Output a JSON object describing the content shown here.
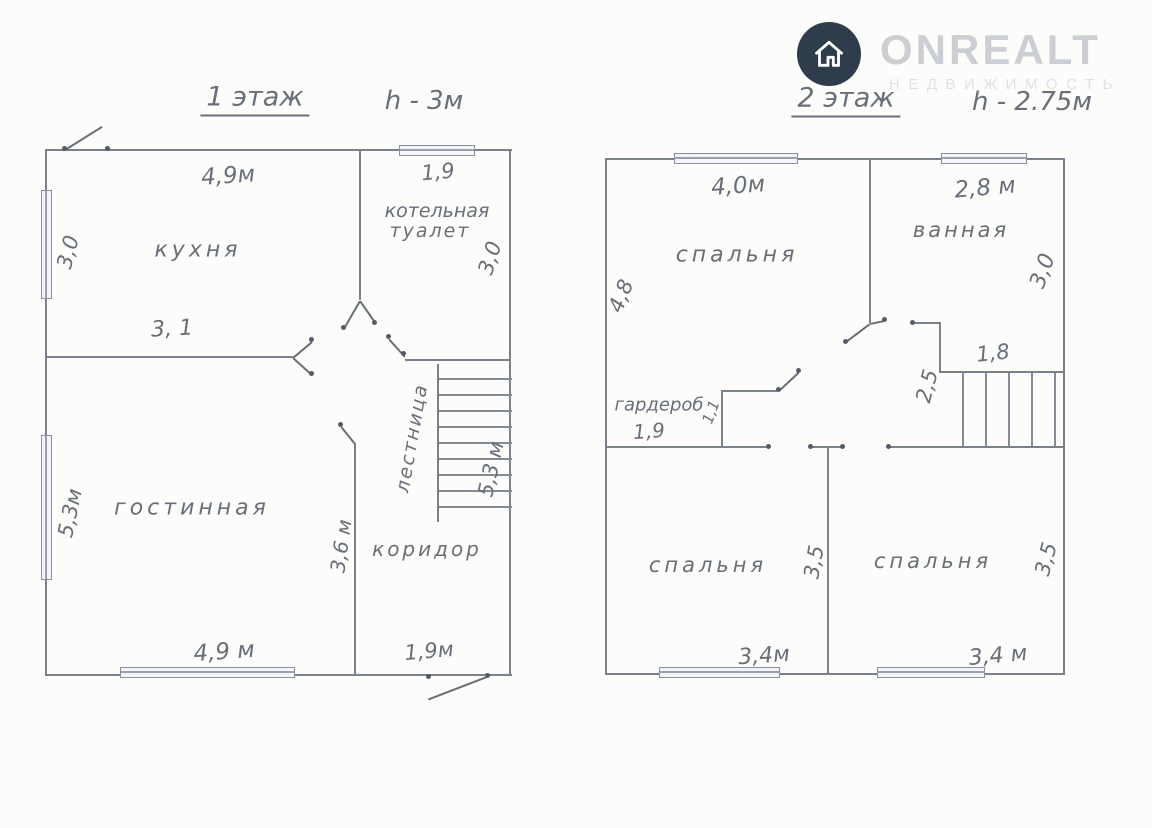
{
  "logo": {
    "brand": "ONREALT",
    "tagline": "НЕДВИЖИМОСТЬ"
  },
  "floor1": {
    "title": "1 этаж",
    "ceiling": "h - 3м",
    "rooms": {
      "kitchen": "кухня",
      "boiler_line1": "котельная",
      "boiler_line2": "туалет",
      "living": "гостинная",
      "corridor": "коридор",
      "stairs": "лестница"
    },
    "dims": {
      "kitchen_top": "4,9м",
      "boiler_top": "1,9",
      "kitchen_left": "3,0",
      "boiler_right": "3,0",
      "kitchen_bottom": "3, 1",
      "living_left": "5,3м",
      "stairs_height": "5,3 м",
      "corridor_wall": "3,6 м",
      "living_bottom": "4,9 м",
      "entry_bottom": "1,9м"
    }
  },
  "floor2": {
    "title": "2 этаж",
    "ceiling": "h - 2.75м",
    "rooms": {
      "bedroom_top": "спальня",
      "bathroom": "ванная",
      "wardrobe": "гардероб",
      "bedroom_left": "спальня",
      "bedroom_right": "спальня"
    },
    "dims": {
      "bedroom_top_w": "4,0м",
      "bathroom_top_w": "2,8 м",
      "bedroom_top_h": "4,8",
      "bathroom_right_h": "3,0",
      "stairs_w": "1,8",
      "stairs_h": "2,5",
      "wardrobe_w": "1,9",
      "wardrobe_d": "1,1",
      "bedroom_left_h": "3,5",
      "bedroom_right_h": "3,5",
      "bedroom_left_w": "3,4м",
      "bedroom_right_w": "3,4 м"
    }
  }
}
